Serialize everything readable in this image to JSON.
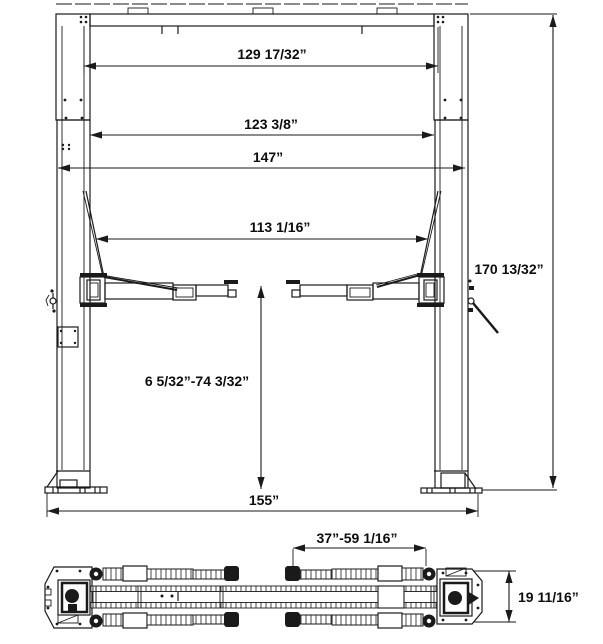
{
  "front_view": {
    "dim_top_beam": "129 17/32”",
    "dim_inside_columns": "123 3/8”",
    "dim_outside_columns": "147”",
    "dim_between_arms": "113 1/16”",
    "dim_overall_height": "170 13/32”",
    "dim_lift_range": "6 5/32”-74 3/32”",
    "dim_base_width": "155”"
  },
  "top_view": {
    "dim_arm_reach": "37”-59 1/16”",
    "dim_base_depth": "19 11/16”"
  },
  "colors": {
    "line": "#1a1a1a",
    "background": "#ffffff"
  }
}
